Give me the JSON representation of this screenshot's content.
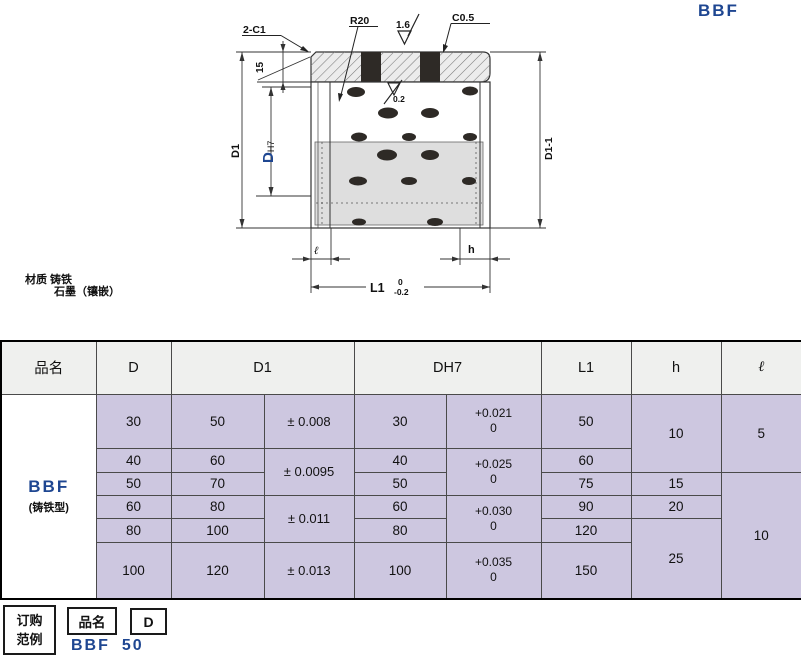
{
  "page": {
    "title": "BBF"
  },
  "drawing": {
    "callouts": {
      "chamfer_left": "2-C1",
      "radius": "R20",
      "roughness_top": "1.6",
      "chamfer_right": "C0.5",
      "roughness_bore": "0.2",
      "insert_depth": "15"
    },
    "dimensions": {
      "outer_dia": "D1",
      "bore_dia": "D",
      "bore_tol": "H7",
      "outer_dia_lower": "D1-1",
      "edge_l": "ℓ",
      "edge_h": "h",
      "length": "L1",
      "length_tol_upper": "0",
      "length_tol_lower": "-0.2"
    },
    "material": {
      "line1": "材质 铸铁",
      "line2": "石墨（镶嵌）"
    }
  },
  "table": {
    "headers": {
      "name": "品名",
      "d": "D",
      "d1": "D1",
      "dh7": "DH7",
      "l1": "L1",
      "h": "h",
      "l": "ℓ"
    },
    "product": {
      "name": "BBF",
      "type": "(铸铁型)"
    },
    "rows": [
      {
        "d": "30",
        "d1": "50",
        "d1_tol": "± 0.008",
        "dh7": "30",
        "dh7_tol": "+0.021\n0",
        "l1": "50",
        "h": "10",
        "l": "5"
      },
      {
        "d": "40",
        "d1": "60",
        "d1_tol": "± 0.0095",
        "dh7": "40",
        "dh7_tol": "+0.025\n0",
        "l1": "60"
      },
      {
        "d": "50",
        "d1": "70",
        "dh7": "50",
        "l1": "75",
        "h": "15",
        "l": "10"
      },
      {
        "d": "60",
        "d1": "80",
        "d1_tol": "± 0.011",
        "dh7": "60",
        "dh7_tol": "+0.030\n0",
        "l1": "90",
        "h": "20"
      },
      {
        "d": "80",
        "d1": "100",
        "dh7": "80",
        "l1": "120",
        "h": "25"
      },
      {
        "d": "100",
        "d1": "120",
        "d1_tol": "± 0.013",
        "dh7": "100",
        "dh7_tol": "+0.035\n0",
        "l1": "150"
      }
    ]
  },
  "order_example": {
    "label": "订购\n范例",
    "field_name": "品名",
    "field_d": "D",
    "example_name": "BBF",
    "example_d": "50"
  }
}
